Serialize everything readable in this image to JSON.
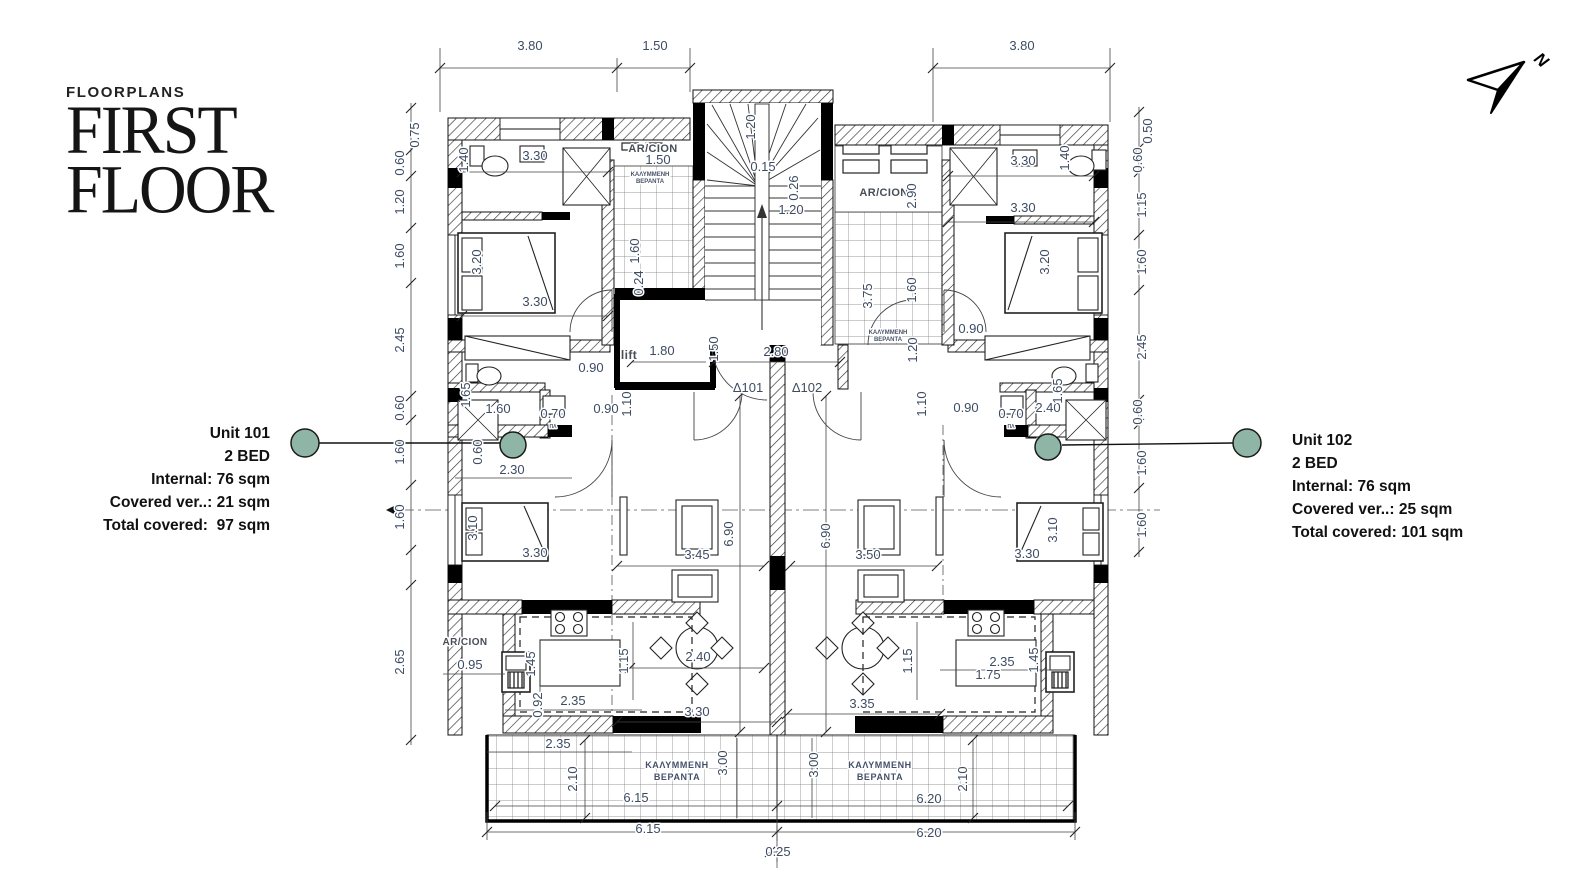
{
  "header": {
    "eyebrow": "FLOORPLANS",
    "title_line1": "FIRST",
    "title_line2": "FLOOR"
  },
  "units": [
    {
      "name": "Unit 101",
      "beds": "2 BED",
      "internal": "Internal: 76 sqm",
      "covered": "Covered ver..: 21 sqm",
      "total": "Total covered:  97 sqm"
    },
    {
      "name": "Unit 102",
      "beds": "2 BED",
      "internal": "Internal: 76 sqm",
      "covered": "Covered ver..: 25 sqm",
      "total": "Total covered: 101 sqm"
    }
  ],
  "compass": {
    "label": "N"
  },
  "colors": {
    "marker": "#8fb5a6",
    "dim_text": "#3d4c63",
    "wall": "#111111"
  },
  "plan": {
    "labels": [
      {
        "t": "3.80",
        "x": 530,
        "y": 50
      },
      {
        "t": "1.50",
        "x": 655,
        "y": 50
      },
      {
        "t": "3.80",
        "x": 1022,
        "y": 50
      },
      {
        "t": "0.75",
        "x": 419,
        "y": 135,
        "r": -90
      },
      {
        "t": "0.60",
        "x": 404,
        "y": 163,
        "r": -90
      },
      {
        "t": "1.20",
        "x": 404,
        "y": 202,
        "r": -90
      },
      {
        "t": "1.60",
        "x": 404,
        "y": 256,
        "r": -90
      },
      {
        "t": "2.45",
        "x": 404,
        "y": 340,
        "r": -90
      },
      {
        "t": "0.60",
        "x": 404,
        "y": 408,
        "r": -90
      },
      {
        "t": "1.60",
        "x": 404,
        "y": 452,
        "r": -90
      },
      {
        "t": "1.60",
        "x": 404,
        "y": 517,
        "r": -90
      },
      {
        "t": "2.65",
        "x": 404,
        "y": 662,
        "r": -90
      },
      {
        "t": "0.50",
        "x": 1152,
        "y": 131,
        "r": -90
      },
      {
        "t": "0.60",
        "x": 1142,
        "y": 160,
        "r": -90
      },
      {
        "t": "1.15",
        "x": 1146,
        "y": 205,
        "r": -90
      },
      {
        "t": "1.60",
        "x": 1146,
        "y": 262,
        "r": -90
      },
      {
        "t": "2.45",
        "x": 1146,
        "y": 347,
        "r": -90
      },
      {
        "t": "0.60",
        "x": 1142,
        "y": 412,
        "r": -90
      },
      {
        "t": "1.60",
        "x": 1146,
        "y": 463,
        "r": -90
      },
      {
        "t": "1.60",
        "x": 1146,
        "y": 525,
        "r": -90
      },
      {
        "t": "1.20",
        "x": 755,
        "y": 127,
        "r": -90
      },
      {
        "t": "0.15",
        "x": 763,
        "y": 171
      },
      {
        "t": "0.26",
        "x": 798,
        "y": 188,
        "r": -90
      },
      {
        "t": "1.20",
        "x": 791,
        "y": 214
      },
      {
        "t": "AR/CION",
        "x": 653,
        "y": 152,
        "c": "room",
        "s": 11
      },
      {
        "t": "1.50",
        "x": 658,
        "y": 164
      },
      {
        "t": "ΚΑΛΥΜΜΕΝΗ",
        "x": 650,
        "y": 176,
        "c": "tiny",
        "s": 6
      },
      {
        "t": "ΒΕΡΑΝΤΑ",
        "x": 650,
        "y": 183,
        "c": "tiny",
        "s": 6
      },
      {
        "t": "1.60",
        "x": 639,
        "y": 251,
        "r": -90
      },
      {
        "t": "0.24",
        "x": 643,
        "y": 283,
        "r": -90
      },
      {
        "t": "AR/CION",
        "x": 884,
        "y": 196,
        "c": "room",
        "s": 11
      },
      {
        "t": "2.90",
        "x": 916,
        "y": 196,
        "r": -90
      },
      {
        "t": "3.75",
        "x": 872,
        "y": 296,
        "r": -90
      },
      {
        "t": "1.60",
        "x": 916,
        "y": 290,
        "r": -90
      },
      {
        "t": "ΚΑΛΥΜΜΕΝΗ",
        "x": 888,
        "y": 334,
        "c": "tiny",
        "s": 6
      },
      {
        "t": "ΒΕΡΑΝΤΑ",
        "x": 888,
        "y": 341,
        "c": "tiny",
        "s": 6
      },
      {
        "t": "1.20",
        "x": 917,
        "y": 350,
        "r": -90
      },
      {
        "t": "3.30",
        "x": 535,
        "y": 160
      },
      {
        "t": "1.40",
        "x": 468,
        "y": 160,
        "r": -90
      },
      {
        "t": "3.30",
        "x": 535,
        "y": 306
      },
      {
        "t": "3.20",
        "x": 481,
        "y": 262,
        "r": -90
      },
      {
        "t": "3.30",
        "x": 1023,
        "y": 165
      },
      {
        "t": "1.40",
        "x": 1069,
        "y": 158,
        "r": -90
      },
      {
        "t": "3.30",
        "x": 1023,
        "y": 212
      },
      {
        "t": "3.20",
        "x": 1049,
        "y": 262,
        "r": -90
      },
      {
        "t": "0.90",
        "x": 971,
        "y": 333
      },
      {
        "t": "0.90",
        "x": 591,
        "y": 372
      },
      {
        "t": "1.65",
        "x": 470,
        "y": 395,
        "r": -90
      },
      {
        "t": "1.60",
        "x": 498,
        "y": 413
      },
      {
        "t": "0.70",
        "x": 553,
        "y": 418
      },
      {
        "t": "0.90",
        "x": 606,
        "y": 413
      },
      {
        "t": "1.10",
        "x": 631,
        "y": 404,
        "r": -90
      },
      {
        "t": "0.60",
        "x": 482,
        "y": 452,
        "r": -90
      },
      {
        "t": "2.30",
        "x": 512,
        "y": 474
      },
      {
        "t": "0.90",
        "x": 966,
        "y": 412
      },
      {
        "t": "0.70",
        "x": 1011,
        "y": 418
      },
      {
        "t": "2.40",
        "x": 1048,
        "y": 412
      },
      {
        "t": "1.65",
        "x": 1062,
        "y": 391,
        "r": -90
      },
      {
        "t": "1.10",
        "x": 926,
        "y": 404,
        "r": -90
      },
      {
        "t": "ΠΛ",
        "x": 553,
        "y": 428,
        "c": "tiny",
        "s": 5
      },
      {
        "t": "ΠΛ",
        "x": 1011,
        "y": 428,
        "c": "tiny",
        "s": 5
      },
      {
        "t": "lift",
        "x": 629,
        "y": 359,
        "c": "room",
        "s": 12
      },
      {
        "t": "1.80",
        "x": 662,
        "y": 355
      },
      {
        "t": "1.50",
        "x": 718,
        "y": 349,
        "r": -90
      },
      {
        "t": "2.80",
        "x": 776,
        "y": 356
      },
      {
        "t": "Δ101",
        "x": 748,
        "y": 392
      },
      {
        "t": "Δ102",
        "x": 807,
        "y": 392
      },
      {
        "t": "3.45",
        "x": 697,
        "y": 559
      },
      {
        "t": "6.90",
        "x": 733,
        "y": 534,
        "r": -90
      },
      {
        "t": "6.90",
        "x": 830,
        "y": 536,
        "r": -90
      },
      {
        "t": "3.50",
        "x": 868,
        "y": 559
      },
      {
        "t": "1.15",
        "x": 628,
        "y": 661,
        "r": -90
      },
      {
        "t": "2.40",
        "x": 698,
        "y": 661
      },
      {
        "t": "1.15",
        "x": 912,
        "y": 661,
        "r": -90
      },
      {
        "t": "3.10",
        "x": 477,
        "y": 528,
        "r": -90
      },
      {
        "t": "3.30",
        "x": 535,
        "y": 557
      },
      {
        "t": "3.10",
        "x": 1057,
        "y": 530,
        "r": -90
      },
      {
        "t": "3.30",
        "x": 1027,
        "y": 558
      },
      {
        "t": "AR/CION",
        "x": 465,
        "y": 645,
        "c": "room",
        "s": 10
      },
      {
        "t": "0.95",
        "x": 470,
        "y": 669
      },
      {
        "t": "1.45",
        "x": 535,
        "y": 664,
        "r": -90
      },
      {
        "t": "0.92",
        "x": 542,
        "y": 705,
        "r": -90
      },
      {
        "t": "2.35",
        "x": 573,
        "y": 705
      },
      {
        "t": "2.35",
        "x": 558,
        "y": 748
      },
      {
        "t": "2.10",
        "x": 577,
        "y": 779,
        "r": -90
      },
      {
        "t": "ΚΑΛΥΜΜΕΝΗ",
        "x": 677,
        "y": 768,
        "c": "room2",
        "s": 9
      },
      {
        "t": "ΒΕΡΑΝΤΑ",
        "x": 677,
        "y": 780,
        "c": "room2",
        "s": 9
      },
      {
        "t": "3.30",
        "x": 697,
        "y": 716
      },
      {
        "t": "3.00",
        "x": 727,
        "y": 763,
        "r": -90
      },
      {
        "t": "6.15",
        "x": 636,
        "y": 802
      },
      {
        "t": "6.15",
        "x": 648,
        "y": 833
      },
      {
        "t": "3.35",
        "x": 862,
        "y": 708
      },
      {
        "t": "3.00",
        "x": 818,
        "y": 765,
        "r": -90
      },
      {
        "t": "ΚΑΛΥΜΜΕΝΗ",
        "x": 880,
        "y": 768,
        "c": "room2",
        "s": 9
      },
      {
        "t": "ΒΕΡΑΝΤΑ",
        "x": 880,
        "y": 780,
        "c": "room2",
        "s": 9
      },
      {
        "t": "2.10",
        "x": 967,
        "y": 779,
        "r": -90
      },
      {
        "t": "6.20",
        "x": 929,
        "y": 803
      },
      {
        "t": "6.20",
        "x": 929,
        "y": 837
      },
      {
        "t": "0.25",
        "x": 778,
        "y": 856
      },
      {
        "t": "2.35",
        "x": 1002,
        "y": 666
      },
      {
        "t": "1.75",
        "x": 988,
        "y": 679
      },
      {
        "t": "1.45",
        "x": 1038,
        "y": 660,
        "r": -90
      }
    ]
  }
}
